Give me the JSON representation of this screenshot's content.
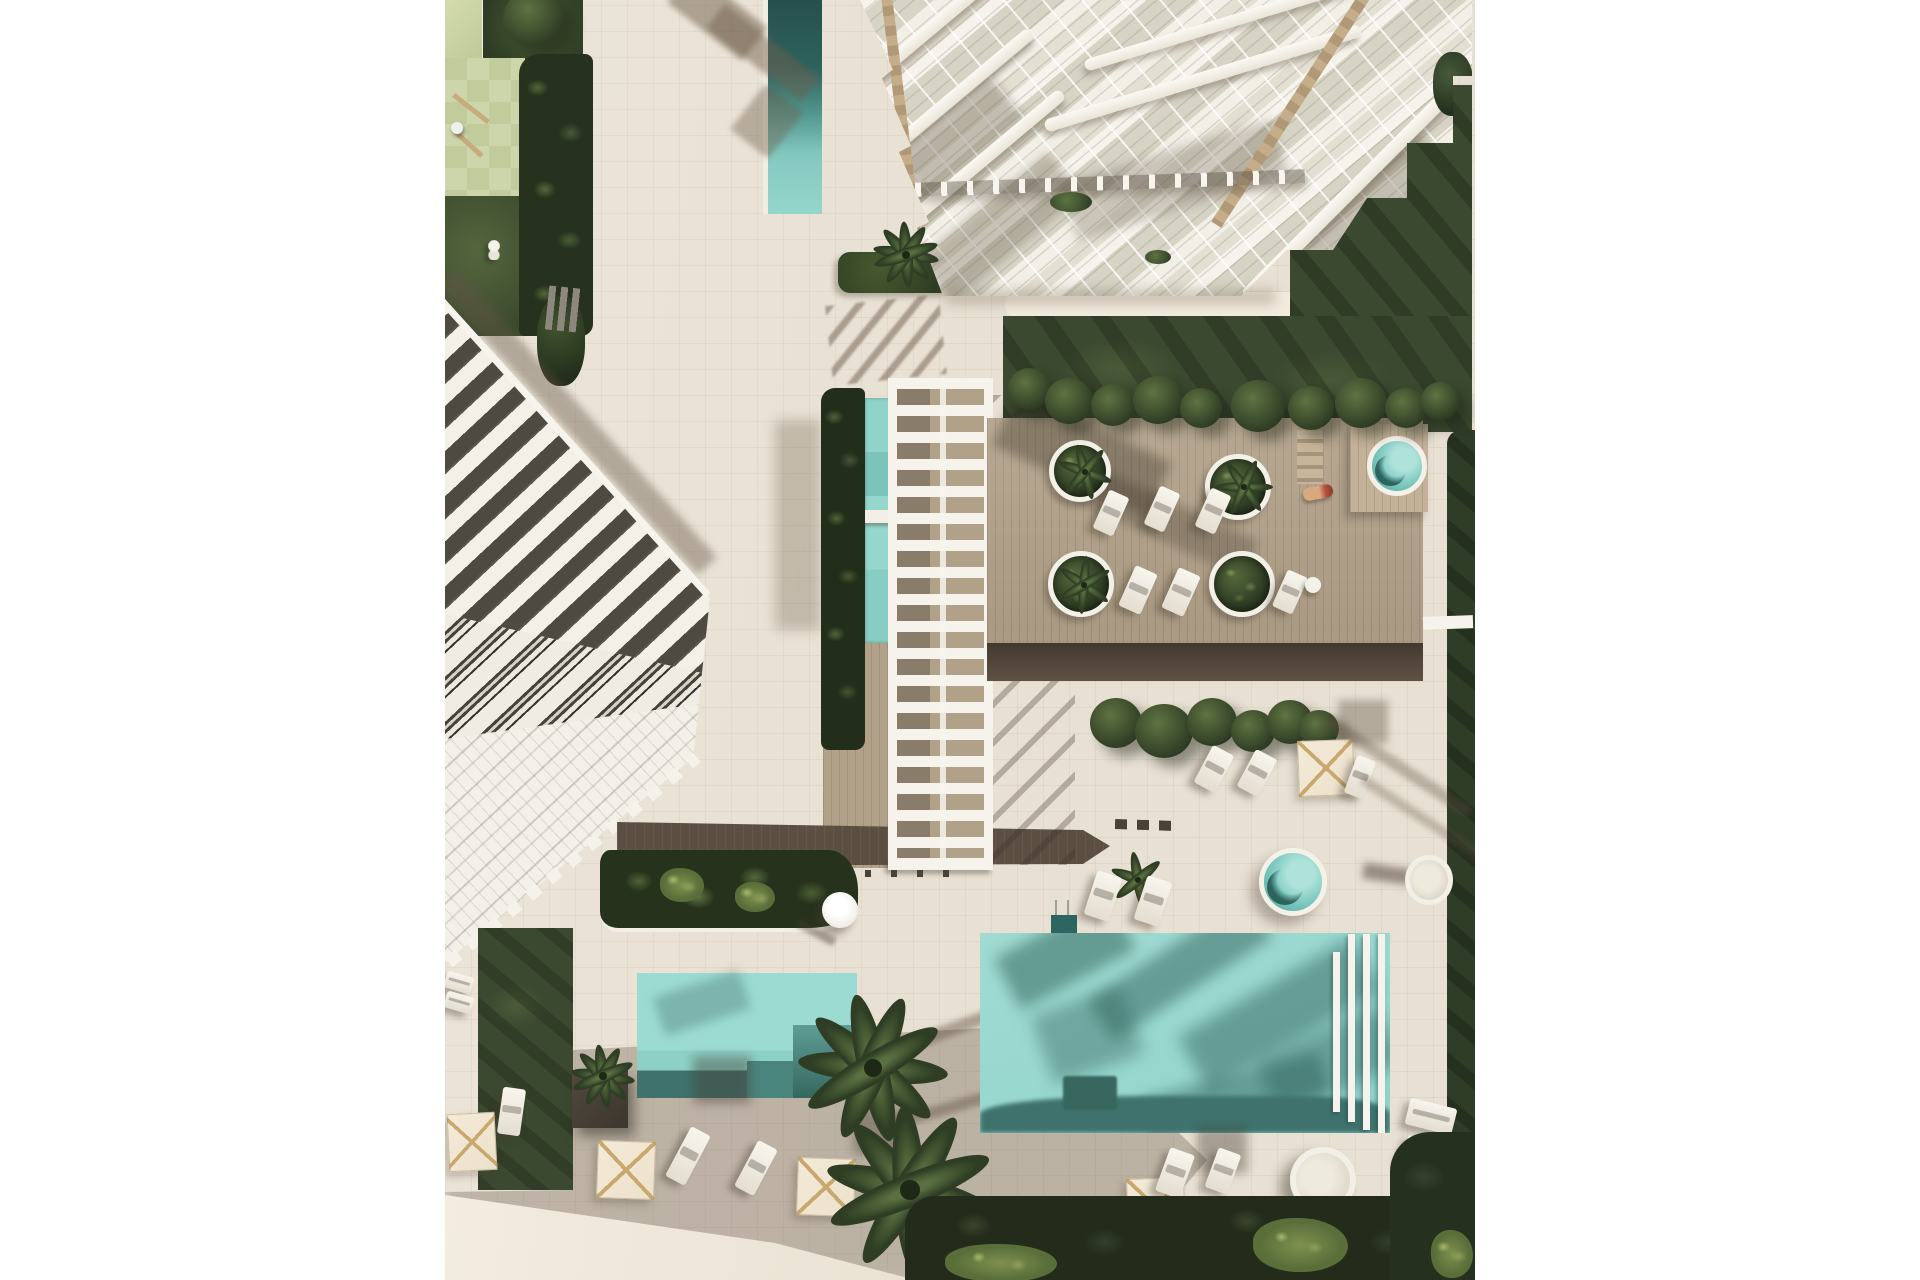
{
  "scene": {
    "type": "aerial-architectural-render",
    "description": "Top-down 3D rendering of a residential resort complex: white apartment tower, row of white townhouses, pergola-covered lap pool, wooden sun deck with round planters and jacuzzis, large turquoise swimming pool, small pool, lawns, palm trees, umbrellas and sun loungers",
    "text_content": "none"
  },
  "palette": {
    "page_bg": "#ffffff",
    "paving": "#e8e0d2",
    "paving_light": "#f2ebde",
    "deck_wood": "#b2a189",
    "deck_dark": "#51463a",
    "walkway_dark": "#5b4f42",
    "pool_water": "#97d7ce",
    "pool_water_deep": "#3f726d",
    "pool_small": "#9cdbd2",
    "lawn_dark": "#3b4930",
    "hedge_green": "#2d3b25",
    "leaf_light": "#7e9150",
    "play_green": "#cdd5aa",
    "play_green_alt": "#c2cb9c",
    "building_white": "#f4f1ea",
    "roof_dark": "#4e4a42",
    "glass": "#d7d4c6",
    "timber": "#c5ad8a",
    "umbrella_cream": "#ece1cb",
    "umbrella_rib": "#c9a86e"
  },
  "inventory": {
    "pools": [
      "main-pool",
      "small-pool",
      "lap-pool",
      "rooftop-lap-pool",
      "jacuzzi-deck",
      "jacuzzi-terrace"
    ],
    "buildings": [
      "tower-building",
      "townhouse-row"
    ],
    "amenities": [
      "pool-pergola",
      "wood-deck",
      "round-planters",
      "sun-loungers",
      "umbrellas",
      "round-daybed",
      "garden-bench",
      "playground"
    ],
    "vegetation": [
      "lawns",
      "hedges",
      "palm-trees",
      "tree-row",
      "planting-beds"
    ]
  }
}
